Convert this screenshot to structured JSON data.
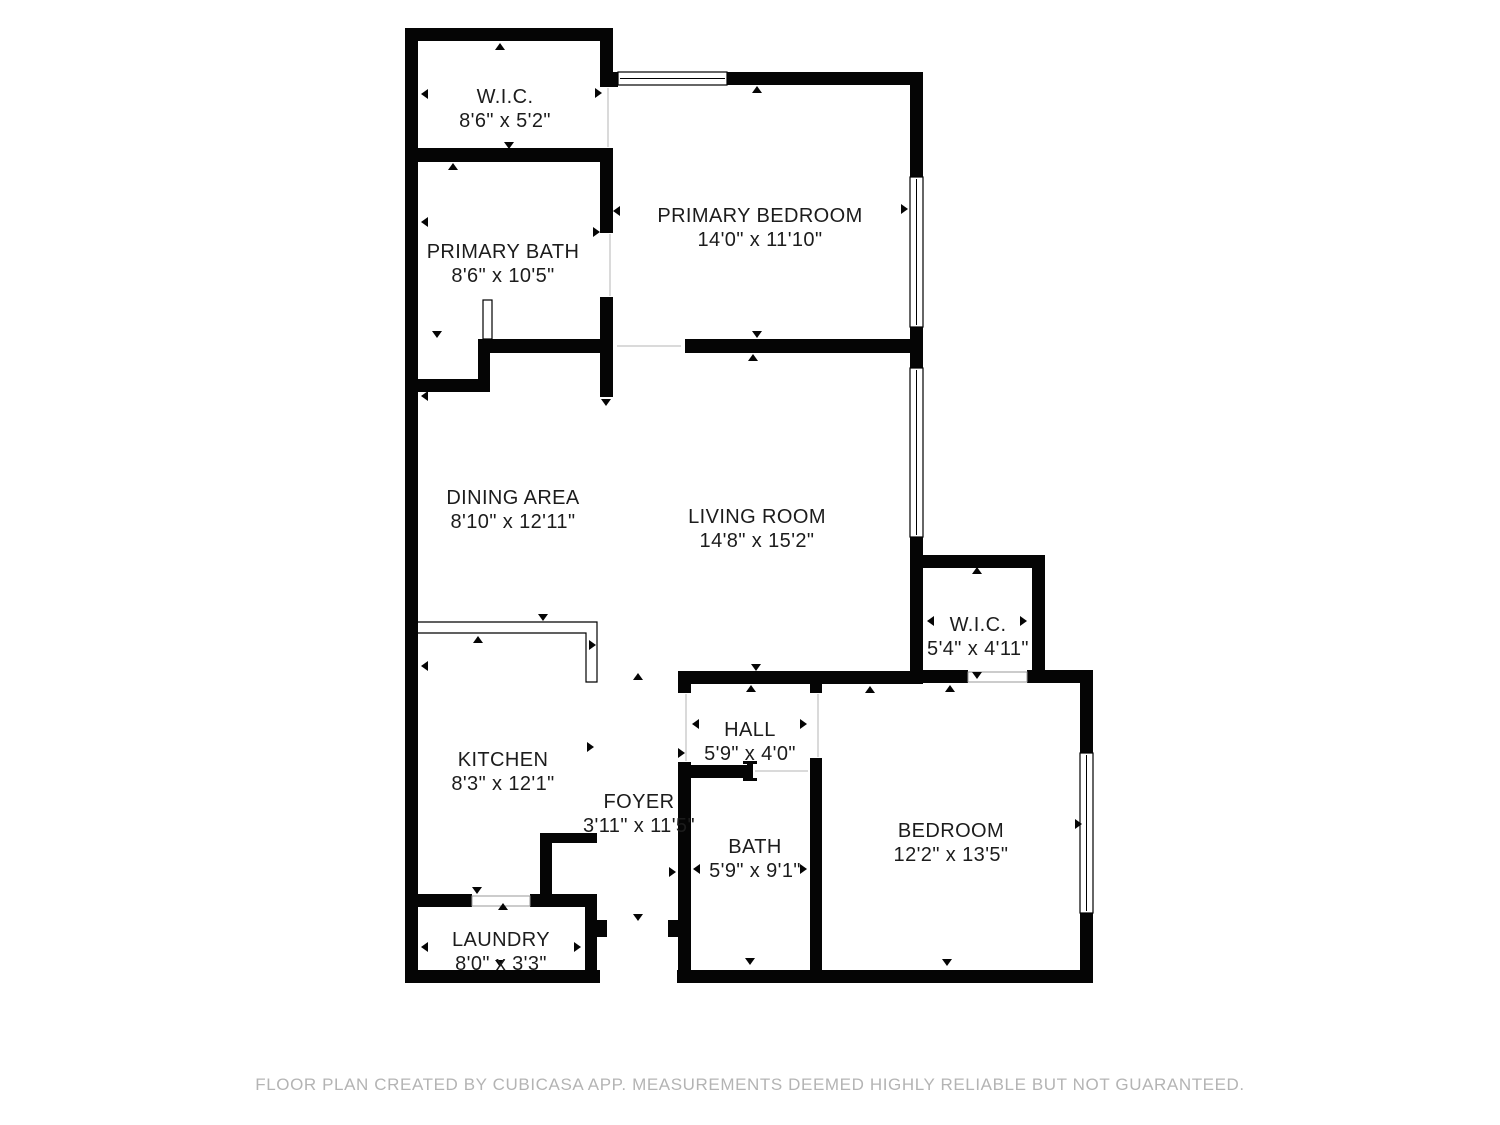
{
  "footer": {
    "text": "FLOOR PLAN CREATED BY CUBICASA APP. MEASUREMENTS DEEMED HIGHLY RELIABLE BUT NOT GUARANTEED.",
    "color": "#b4b4b4",
    "x": 750,
    "y": 1090
  },
  "plan": {
    "canvas": {
      "width": 1500,
      "height": 1125
    },
    "wall_color": "#050505",
    "line_color": "#000000",
    "threshold_color": "#999999",
    "rooms": [
      {
        "name": "W.I.C.",
        "dims": "8'6\" x 5'2\"",
        "x": 505,
        "y": 103
      },
      {
        "name": "PRIMARY BATH",
        "dims": "8'6\" x 10'5\"",
        "x": 503,
        "y": 258
      },
      {
        "name": "PRIMARY BEDROOM",
        "dims": "14'0\" x 11'10\"",
        "x": 760,
        "y": 222
      },
      {
        "name": "DINING AREA",
        "dims": "8'10\" x 12'11\"",
        "x": 513,
        "y": 504
      },
      {
        "name": "LIVING ROOM",
        "dims": "14'8\" x 15'2\"",
        "x": 757,
        "y": 523
      },
      {
        "name": "W.I.C.",
        "dims": "5'4\" x 4'11\"",
        "x": 978,
        "y": 631
      },
      {
        "name": "HALL",
        "dims": "5'9\" x 4'0\"",
        "x": 750,
        "y": 736
      },
      {
        "name": "KITCHEN",
        "dims": "8'3\" x 12'1\"",
        "x": 503,
        "y": 766
      },
      {
        "name": "FOYER",
        "dims": "3'11\" x 11'5\"",
        "x": 639,
        "y": 808
      },
      {
        "name": "BATH",
        "dims": "5'9\" x 9'1\"",
        "x": 755,
        "y": 853
      },
      {
        "name": "BEDROOM",
        "dims": "12'2\" x 13'5\"",
        "x": 951,
        "y": 837
      },
      {
        "name": "LAUNDRY",
        "dims": "8'0\" x 3'3\"",
        "x": 501,
        "y": 946
      }
    ],
    "walls": [
      [
        405,
        28,
        208,
        13
      ],
      [
        405,
        28,
        13,
        955
      ],
      [
        600,
        28,
        13,
        59
      ],
      [
        405,
        148,
        208,
        14
      ],
      [
        600,
        148,
        13,
        85
      ],
      [
        600,
        297,
        13,
        100
      ],
      [
        600,
        72,
        18,
        15
      ],
      [
        727,
        72,
        196,
        13
      ],
      [
        910,
        72,
        13,
        105
      ],
      [
        910,
        327,
        13,
        41
      ],
      [
        910,
        537,
        13,
        31
      ],
      [
        685,
        339,
        238,
        14
      ],
      [
        478,
        339,
        135,
        14
      ],
      [
        478,
        339,
        12,
        53
      ],
      [
        405,
        379,
        85,
        13
      ],
      [
        678,
        671,
        245,
        13
      ],
      [
        910,
        555,
        135,
        13
      ],
      [
        1032,
        555,
        13,
        128
      ],
      [
        910,
        568,
        13,
        115
      ],
      [
        910,
        670,
        58,
        13
      ],
      [
        1027,
        670,
        66,
        13
      ],
      [
        1080,
        683,
        13,
        70
      ],
      [
        1080,
        913,
        13,
        70
      ],
      [
        677,
        970,
        416,
        13
      ],
      [
        678,
        684,
        13,
        9
      ],
      [
        678,
        762,
        13,
        208
      ],
      [
        668,
        920,
        10,
        17
      ],
      [
        810,
        684,
        12,
        9
      ],
      [
        810,
        758,
        12,
        212
      ],
      [
        678,
        765,
        70,
        13
      ],
      [
        405,
        894,
        67,
        13
      ],
      [
        530,
        894,
        67,
        13
      ],
      [
        585,
        894,
        12,
        89
      ],
      [
        405,
        970,
        195,
        13
      ],
      [
        597,
        920,
        10,
        17
      ],
      [
        540,
        833,
        57,
        10
      ],
      [
        540,
        833,
        12,
        64
      ]
    ],
    "windows": [
      {
        "x": 618,
        "y": 72,
        "w": 109,
        "h": 13,
        "orient": "h"
      },
      {
        "x": 910,
        "y": 177,
        "w": 13,
        "h": 150,
        "orient": "v"
      },
      {
        "x": 910,
        "y": 368,
        "w": 13,
        "h": 169,
        "orient": "v"
      },
      {
        "x": 1080,
        "y": 753,
        "w": 13,
        "h": 160,
        "orient": "v"
      }
    ],
    "openings": [
      [
        472,
        896,
        58,
        10
      ],
      [
        968,
        672,
        59,
        10
      ]
    ],
    "threshold_lines": [
      [
        608,
        88,
        608,
        147
      ],
      [
        610,
        234,
        610,
        296
      ],
      [
        617,
        346,
        681,
        346
      ],
      [
        818,
        694,
        818,
        757
      ],
      [
        686,
        694,
        686,
        761
      ],
      [
        755,
        771,
        808,
        771
      ]
    ],
    "door_leaves_white": [
      [
        483,
        300,
        9,
        39
      ]
    ],
    "door_leaves_black": [
      [
        747,
        762,
        6,
        19
      ],
      [
        743,
        761,
        14,
        3
      ],
      [
        743,
        778,
        14,
        3
      ]
    ],
    "counter_path": "M417,622 h180 v60 h-11 v-49 h-169 Z",
    "arrows": [
      [
        500,
        47,
        "up"
      ],
      [
        509,
        145,
        "down"
      ],
      [
        453,
        167,
        "up"
      ],
      [
        425,
        94,
        "left"
      ],
      [
        598,
        93,
        "right"
      ],
      [
        425,
        222,
        "left"
      ],
      [
        617,
        211,
        "left"
      ],
      [
        596,
        232,
        "right"
      ],
      [
        437,
        334,
        "down"
      ],
      [
        425,
        396,
        "left"
      ],
      [
        606,
        402,
        "down"
      ],
      [
        757,
        90,
        "up"
      ],
      [
        904,
        209,
        "right"
      ],
      [
        757,
        334,
        "down"
      ],
      [
        753,
        358,
        "up"
      ],
      [
        543,
        617,
        "down"
      ],
      [
        478,
        640,
        "up"
      ],
      [
        590,
        747,
        "right"
      ],
      [
        425,
        666,
        "left"
      ],
      [
        592,
        645,
        "right"
      ],
      [
        638,
        677,
        "up"
      ],
      [
        672,
        872,
        "right"
      ],
      [
        638,
        917,
        "down"
      ],
      [
        696,
        724,
        "left"
      ],
      [
        803,
        724,
        "right"
      ],
      [
        756,
        667,
        "down"
      ],
      [
        751,
        689,
        "up"
      ],
      [
        681,
        753,
        "right"
      ],
      [
        697,
        869,
        "left"
      ],
      [
        803,
        869,
        "right"
      ],
      [
        750,
        961,
        "down"
      ],
      [
        870,
        690,
        "up"
      ],
      [
        947,
        962,
        "down"
      ],
      [
        1078,
        824,
        "right"
      ],
      [
        977,
        571,
        "up"
      ],
      [
        931,
        621,
        "left"
      ],
      [
        1023,
        621,
        "right"
      ],
      [
        977,
        675,
        "down"
      ],
      [
        950,
        689,
        "up"
      ],
      [
        477,
        890,
        "down"
      ],
      [
        503,
        907,
        "up"
      ],
      [
        425,
        947,
        "left"
      ],
      [
        577,
        947,
        "right"
      ],
      [
        500,
        963,
        "down"
      ]
    ]
  }
}
